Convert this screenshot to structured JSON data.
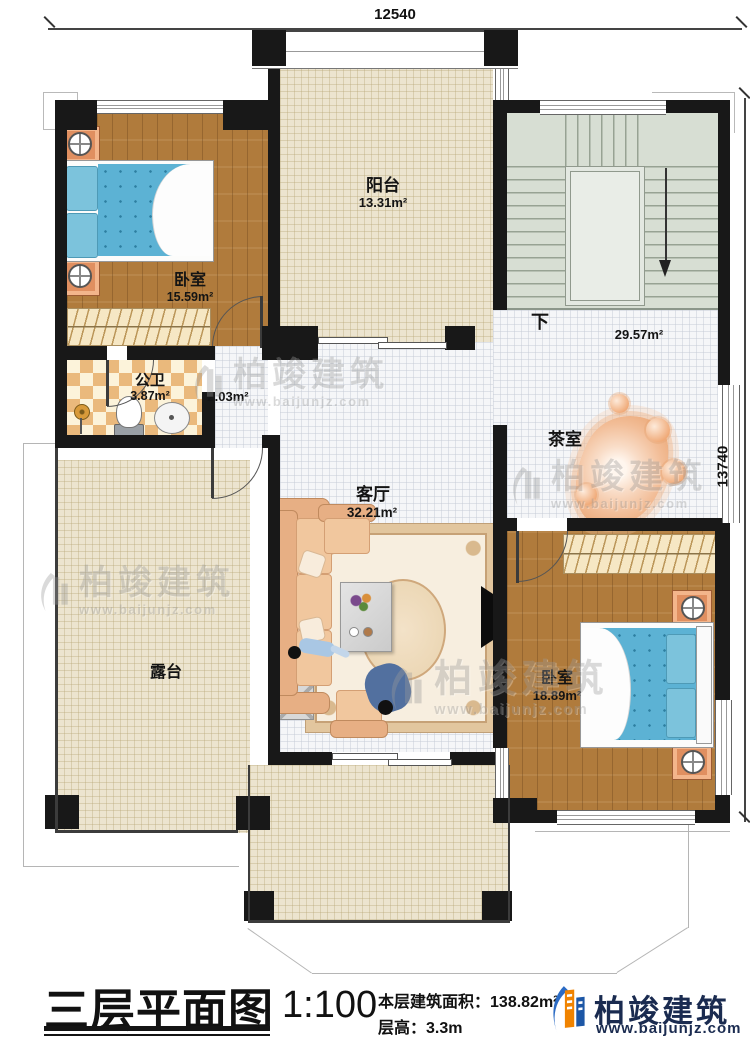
{
  "dims": {
    "top": "12540",
    "right": "13740"
  },
  "rooms": {
    "balcony": {
      "name": "阳台",
      "area": "13.31m²"
    },
    "bedroom1": {
      "name": "卧室",
      "area": "15.59m²"
    },
    "stairwell": {
      "down_label": "下",
      "area": "29.57m²"
    },
    "bathroom": {
      "name": "公卫",
      "area": "3.87m²"
    },
    "hallway": {
      "area": "2.03m²"
    },
    "living": {
      "name": "客厅",
      "area": "32.21m²"
    },
    "tearoom": {
      "name": "茶室"
    },
    "bedroom2": {
      "name": "卧室",
      "area": "18.89m²"
    },
    "terrace": {
      "name": "露台"
    }
  },
  "watermark": {
    "name": "柏竣建筑",
    "site": "www.baijunjz.com"
  },
  "titleblock": {
    "plan_title": "三层平面图",
    "scale": "1:100",
    "area_label": "本层建筑面积：",
    "area_value": "138.82m²",
    "floor_height_label": "层高：",
    "floor_height_value": "3.3m",
    "brand_name": "柏竣建筑",
    "brand_site": "www.baijunjz.com"
  },
  "colors": {
    "wall": "#181818",
    "brand_navy": "#1a2b50",
    "brand_blue": "#2b6bc4",
    "brand_orange": "#f08300"
  }
}
